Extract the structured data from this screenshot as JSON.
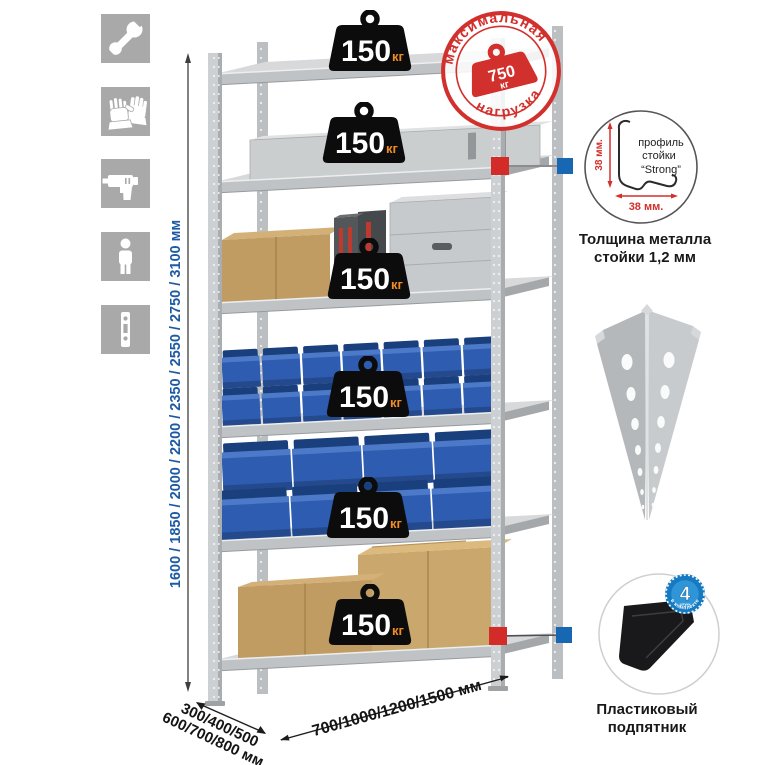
{
  "colors": {
    "accent_red": "#d2302c",
    "connector_red": "#d32b28",
    "connector_blue": "#1767b2",
    "label_blue": "#1d5aa4",
    "icon_bg": "#a9a9a9",
    "badge_black": "#0c0c0c",
    "badge_unit_orange": "#f08c21",
    "bin_blue": "#2d5cb0",
    "metal_gray": "#c6c9cb",
    "cardboard": "#c3a06a"
  },
  "left_icons": [
    {
      "name": "wrench-icon"
    },
    {
      "name": "gloves-icon"
    },
    {
      "name": "drill-icon"
    },
    {
      "name": "person-icon"
    },
    {
      "name": "post-profile-icon"
    }
  ],
  "dimensions": {
    "height_options": "1600 / 1850 / 2000 / 2200 / 2350 / 2550 / 2750 / 3100 мм",
    "depth_options_line1": "300/400/500",
    "depth_options_line2": "600/700/800 мм",
    "width_options": "700/1000/1200/1500 мм"
  },
  "rack": {
    "shelves": [
      {
        "load": "150",
        "unit": "кг"
      },
      {
        "load": "150",
        "unit": "кг"
      },
      {
        "load": "150",
        "unit": "кг"
      },
      {
        "load": "150",
        "unit": "кг"
      },
      {
        "load": "150",
        "unit": "кг"
      },
      {
        "load": "150",
        "unit": "кг"
      }
    ]
  },
  "max_load_stamp": {
    "arc_top": "максимальная",
    "arc_bottom": "нагрузка",
    "value": "750",
    "unit": "кг"
  },
  "profile_detail": {
    "label_line1": "профиль",
    "label_line2": "стойки",
    "label_line3": "“Strong”",
    "dim_vertical": "38 мм.",
    "dim_horizontal": "38 мм.",
    "caption_line1": "Толщина металла",
    "caption_line2": "стойки 1,2 мм"
  },
  "foot_detail": {
    "badge_value": "4",
    "badge_small_text": "штуки",
    "badge_arc_text": "в комплекте",
    "caption_line1": "Пластиковый",
    "caption_line2": "подпятник"
  }
}
